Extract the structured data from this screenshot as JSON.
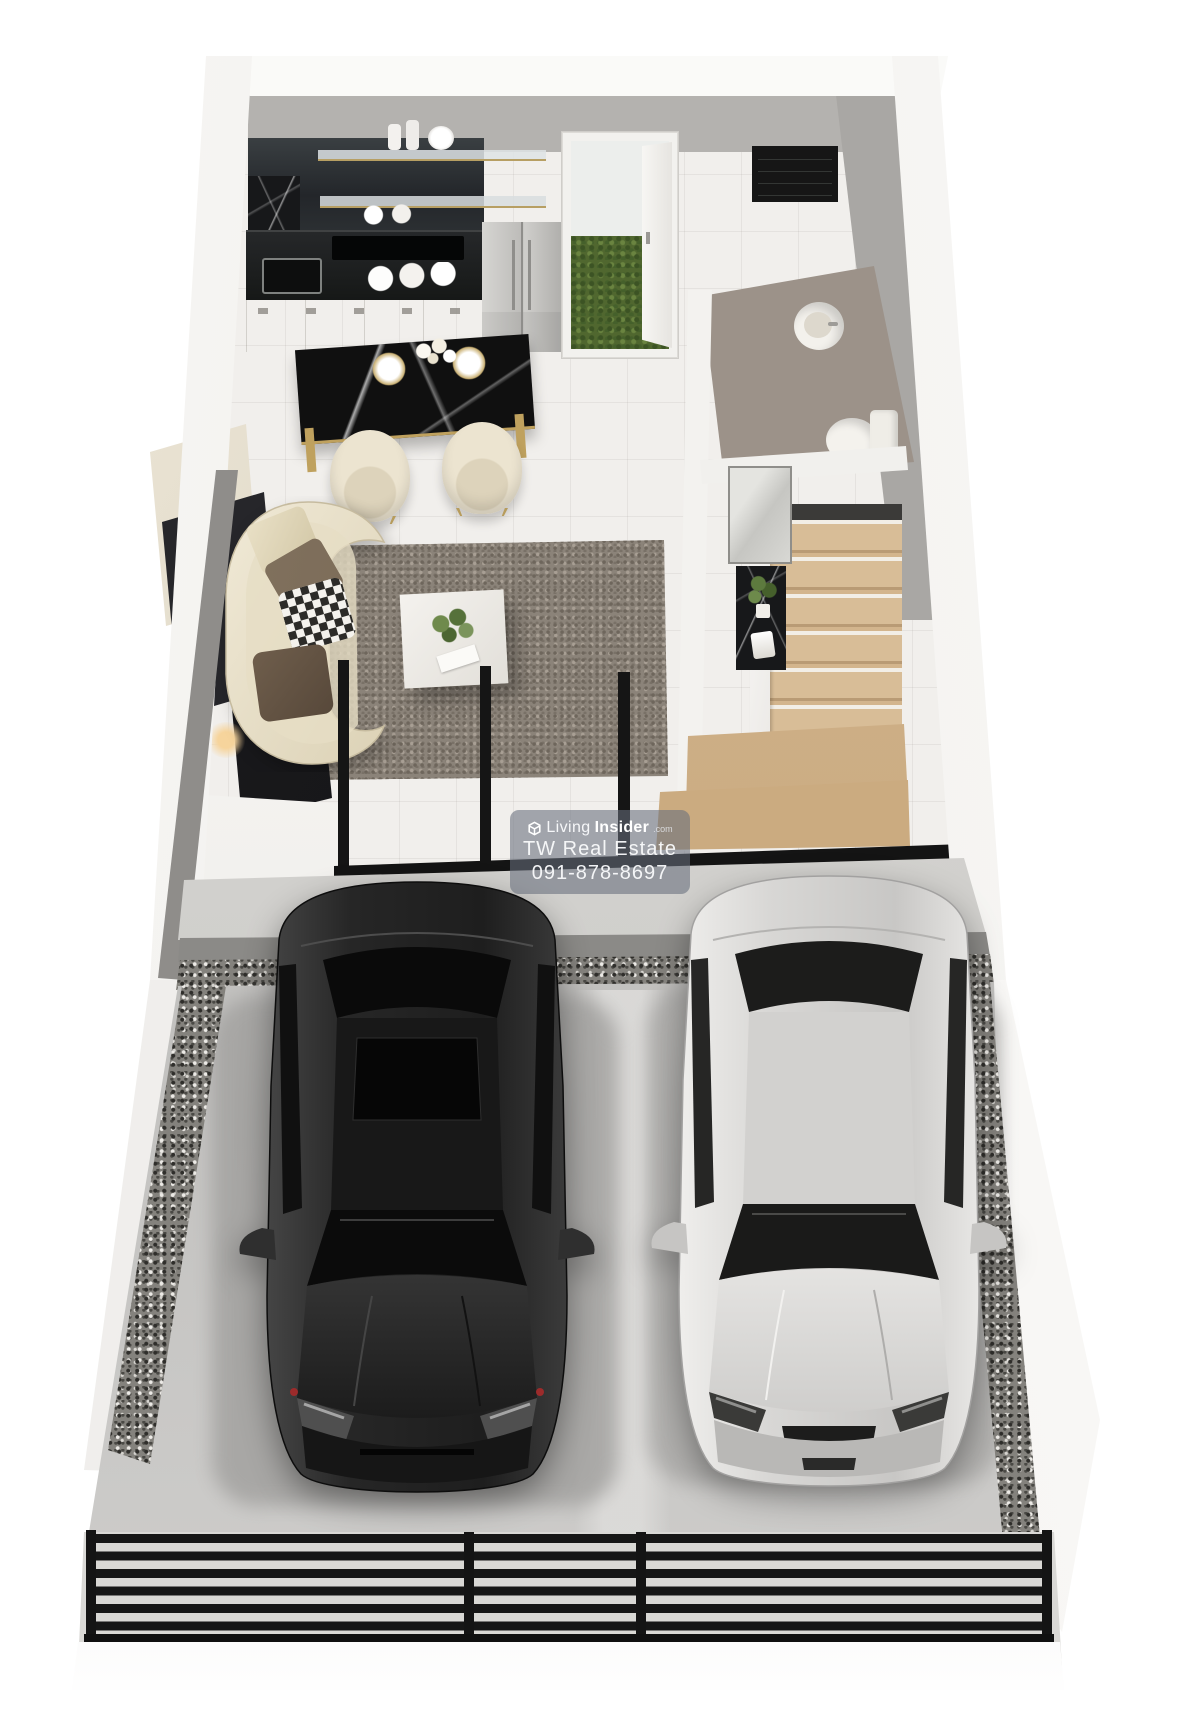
{
  "meta": {
    "kind": "3d-floorplan-render",
    "description": "Top-down 3D render of a townhouse ground floor: kitchen, dining and living zones, bathroom, staircase, and a two-car front parking court behind a black gate"
  },
  "watermark": {
    "logo_icon": "livinginsider-cube-icon",
    "brand": {
      "light": "Living",
      "bold": "Insider",
      "suffix": ".com"
    },
    "agency": "TW Real Estate",
    "phone": "091-878-8697"
  },
  "palette": {
    "background": "#ffffff",
    "wall_white": "#f5f4f1",
    "wall_gray": "#b3b1ae",
    "floor_tile": "#f1efec",
    "bathroom_floor": "#9b9187",
    "stair_wood": "#d2b48f",
    "grass_green": "#55703a",
    "counter_black": "#1d1f1e",
    "cabinet_white": "#ece9e3",
    "gold_accent": "#bba15f",
    "rug_gray": "#8b8379",
    "sofa_cream": "#eae2cc",
    "concrete": "#c7c6c4",
    "gravel_gray": "#84827d",
    "car_black": "#262626",
    "car_silver": "#d6d5d3",
    "fence_black": "#161616",
    "watermark_panel": "rgba(104,110,124,0.58)"
  }
}
